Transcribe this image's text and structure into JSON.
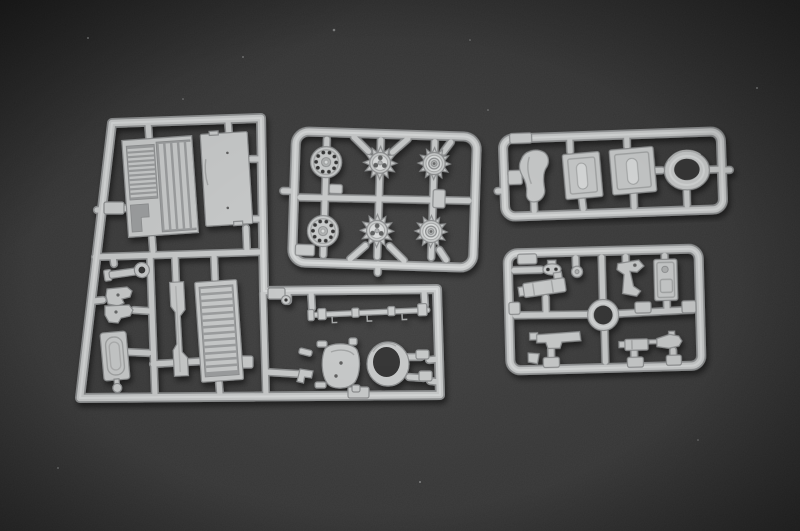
{
  "scene": {
    "type": "photograph",
    "subject": "Four light-grey injection-molded plastic model-kit sprues (parts frames) of an armored vehicle kit lying on a dark grey textured surface",
    "colors": {
      "bg-center": "#424242",
      "bg-edge": "#2a2a2a",
      "plastic-base": "#cbcdcd",
      "plastic-light": "#dcdede",
      "plastic-mid": "#b2b4b4",
      "plastic-edge": "#8f9192",
      "plastic-deep": "#9fa1a2",
      "detail": "#a6a8a8",
      "hole": "#383838"
    },
    "sprues": [
      {
        "id": "large-left",
        "shape": "large L-shaped frame",
        "contents": [
          "engine deck grille panel",
          "flat deck plate",
          "tow shackle wrench",
          "machine-gun parts",
          "hatch door with oval groove",
          "stepped side bracket",
          "louvred intake panel",
          "long tow-bar rod",
          "rounded gun shield",
          "open mantlet ring",
          "assorted small fittings"
        ]
      },
      {
        "id": "wheels-top-center",
        "shape": "rectangular frame",
        "contents": [
          "perforated road-wheel disc x2",
          "toothed drive sprocket x2",
          "coned idler wheel x2"
        ]
      },
      {
        "id": "top-right",
        "shape": "wide rectangular frame",
        "contents": [
          "curved fender",
          "rectangular hatch panel x2",
          "large turret ring"
        ]
      },
      {
        "id": "bottom-right",
        "shape": "rectangular frame",
        "contents": [
          "pulley",
          "round knob",
          "gun cradle box",
          "bent lever arm",
          "tall stowage panel",
          "L-bracket",
          "small gun mounts",
          "central ring"
        ]
      }
    ],
    "wheel_count": 6,
    "ring_count": 3
  }
}
